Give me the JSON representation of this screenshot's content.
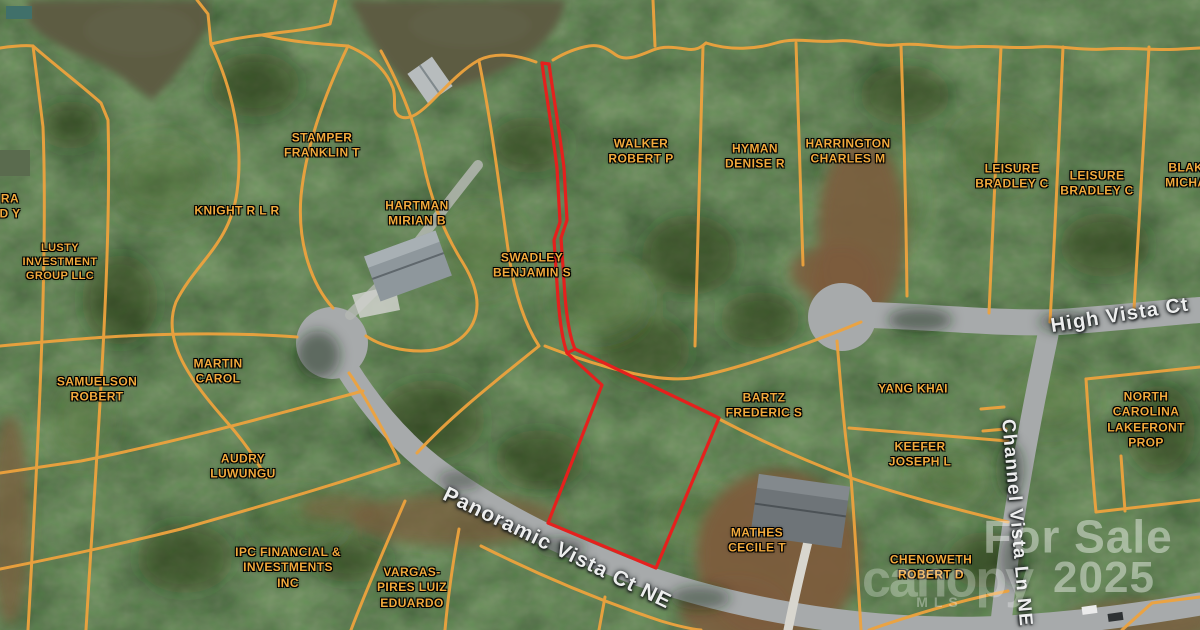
{
  "map": {
    "type": "satellite-parcel-map",
    "highlighted_parcel": "flag-shaped lot outlined in red on Panoramic Vista Ct NE",
    "streets": [
      "Panoramic Vista Ct NE",
      "High Vista Ct",
      "Channel Vista Ln NE"
    ],
    "parcel_owners": [
      "RA D Y",
      "LUSTY INVESTMENT GROUP LLC",
      "STAMPER FRANKLIN T",
      "KNIGHT R L R",
      "HARTMAN MIRIAN B",
      "SWADLEY BENJAMIN S",
      "WALKER ROBERT P",
      "HYMAN DENISE R",
      "HARRINGTON CHARLES M",
      "LEISURE BRADLEY C",
      "LEISURE BRADLEY C",
      "BLAKE MICHAE",
      "MARTIN CAROL",
      "SAMUELSON ROBERT",
      "AUDRY LUWUNGU",
      "IPC FINANCIAL & INVESTMENTS INC",
      "VARGAS-PIRES LUIZ EDUARDO",
      "BARTZ FREDERIC S",
      "YANG KHAI",
      "KEEFER JOSEPH L",
      "NORTH CAROLINA LAKEFRONT PROP",
      "MATHES CECILE T",
      "CHENOWETH ROBERT D"
    ],
    "watermark": {
      "status": "For Sale",
      "year": "2025",
      "brand": "canopy",
      "brand_sub": "MLS"
    }
  },
  "colors": {
    "parcel_line": "#EEA33E",
    "highlight_line": "#E5201D",
    "road": "#A7AAAB",
    "road_edge": "#8E9192",
    "driveway": "#D8D6CE",
    "forest": "#2A3E20",
    "water": "#5D5C42",
    "dirt": "#7C5C3D",
    "parcel_label": "#F2AA3D",
    "street_label": "#EDEEEE",
    "watermark": "#FFFFFF"
  },
  "overlays": [
    {
      "name": "parcel-label-ra-dy",
      "kind": "parcel",
      "text": "RA\nD Y",
      "x": 10,
      "y": 207,
      "size": 12
    },
    {
      "name": "parcel-label-lusty-investment-group-llc",
      "kind": "parcel",
      "text": "LUSTY\nINVESTMENT\nGROUP LLC",
      "x": 60,
      "y": 262,
      "size": 11
    },
    {
      "name": "parcel-label-stamper-franklin-t",
      "kind": "parcel",
      "text": "STAMPER\nFRANKLIN T",
      "x": 322,
      "y": 146,
      "size": 12
    },
    {
      "name": "parcel-label-knight-r-l-r",
      "kind": "parcel",
      "text": "KNIGHT R L R",
      "x": 237,
      "y": 211,
      "size": 12
    },
    {
      "name": "parcel-label-hartman-mirian-b",
      "kind": "parcel",
      "text": "HARTMAN\nMIRIAN B",
      "x": 417,
      "y": 214,
      "size": 12
    },
    {
      "name": "parcel-label-swadley-benjamin-s",
      "kind": "parcel",
      "text": "SWADLEY\nBENJAMIN S",
      "x": 532,
      "y": 266,
      "size": 12
    },
    {
      "name": "parcel-label-walker-robert-p",
      "kind": "parcel",
      "text": "WALKER\nROBERT P",
      "x": 641,
      "y": 152,
      "size": 12
    },
    {
      "name": "parcel-label-hyman-denise-r",
      "kind": "parcel",
      "text": "HYMAN\nDENISE R",
      "x": 755,
      "y": 157,
      "size": 12
    },
    {
      "name": "parcel-label-harrington-charles-m",
      "kind": "parcel",
      "text": "HARRINGTON\nCHARLES M",
      "x": 848,
      "y": 152,
      "size": 12
    },
    {
      "name": "parcel-label-leisure-bradley-c-1",
      "kind": "parcel",
      "text": "LEISURE\nBRADLEY C",
      "x": 1012,
      "y": 177,
      "size": 12
    },
    {
      "name": "parcel-label-leisure-bradley-c-2",
      "kind": "parcel",
      "text": "LEISURE\nBRADLEY C",
      "x": 1097,
      "y": 184,
      "size": 12
    },
    {
      "name": "parcel-label-blake-michae",
      "kind": "parcel",
      "text": "BLAKE\nMICHAE",
      "x": 1190,
      "y": 176,
      "size": 12
    },
    {
      "name": "parcel-label-martin-carol",
      "kind": "parcel",
      "text": "MARTIN\nCAROL",
      "x": 218,
      "y": 372,
      "size": 12
    },
    {
      "name": "parcel-label-samuelson-robert",
      "kind": "parcel",
      "text": "SAMUELSON\nROBERT",
      "x": 97,
      "y": 390,
      "size": 12
    },
    {
      "name": "parcel-label-audry-luwungu",
      "kind": "parcel",
      "text": "AUDRY\nLUWUNGU",
      "x": 243,
      "y": 467,
      "size": 12
    },
    {
      "name": "parcel-label-ipc-financial-investments-inc",
      "kind": "parcel",
      "text": "IPC FINANCIAL &\nINVESTMENTS\nINC",
      "x": 288,
      "y": 568,
      "size": 12
    },
    {
      "name": "parcel-label-vargas-pires-luiz-eduardo",
      "kind": "parcel",
      "text": "VARGAS-\nPIRES LUIZ\nEDUARDO",
      "x": 412,
      "y": 588,
      "size": 12
    },
    {
      "name": "parcel-label-bartz-frederic-s",
      "kind": "parcel",
      "text": "BARTZ\nFREDERIC S",
      "x": 764,
      "y": 406,
      "size": 12
    },
    {
      "name": "parcel-label-yang-khai",
      "kind": "parcel",
      "text": "YANG KHAI",
      "x": 913,
      "y": 389,
      "size": 12
    },
    {
      "name": "parcel-label-keefer-joseph-l",
      "kind": "parcel",
      "text": "KEEFER\nJOSEPH L",
      "x": 920,
      "y": 455,
      "size": 12
    },
    {
      "name": "parcel-label-north-carolina-lakefront-prop",
      "kind": "parcel",
      "text": "NORTH CAROLINA\nLAKEFRONT\nPROP",
      "x": 1146,
      "y": 420,
      "size": 12
    },
    {
      "name": "parcel-label-mathes-cecile-t",
      "kind": "parcel",
      "text": "MATHES\nCECILE T",
      "x": 757,
      "y": 541,
      "size": 12
    },
    {
      "name": "parcel-label-chenoweth-robert-d",
      "kind": "parcel",
      "text": "CHENOWETH\nROBERT D",
      "x": 931,
      "y": 568,
      "size": 12
    },
    {
      "name": "street-label-high-vista-ct",
      "kind": "street",
      "text": "High Vista Ct",
      "x": 1120,
      "y": 316,
      "rotate": -9,
      "size": 20
    },
    {
      "name": "street-label-panoramic-vista-ct-ne",
      "kind": "street",
      "text": "Panoramic Vista Ct NE",
      "x": 557,
      "y": 549,
      "rotate": 26,
      "size": 21
    },
    {
      "name": "street-label-channel-vista-ln-ne",
      "kind": "street",
      "text": "Channel Vista Ln NE",
      "x": 1016,
      "y": 523,
      "rotate": 85,
      "size": 19
    },
    {
      "name": "watermark-for-sale",
      "kind": "watermark",
      "text": "For Sale",
      "x": 1078,
      "y": 537,
      "size": 46,
      "opacity": 0.42
    },
    {
      "name": "watermark-year",
      "kind": "watermark",
      "text": "2025",
      "x": 1104,
      "y": 578,
      "size": 44,
      "opacity": 0.42
    },
    {
      "name": "watermark-brand-canopy",
      "kind": "brand",
      "text": "canopy",
      "x": 947,
      "y": 580,
      "size": 52,
      "opacity": 0.28
    },
    {
      "name": "watermark-brand-mls",
      "kind": "mls",
      "text": "MLS",
      "x": 940,
      "y": 603,
      "size": 14,
      "opacity": 0.32
    }
  ]
}
